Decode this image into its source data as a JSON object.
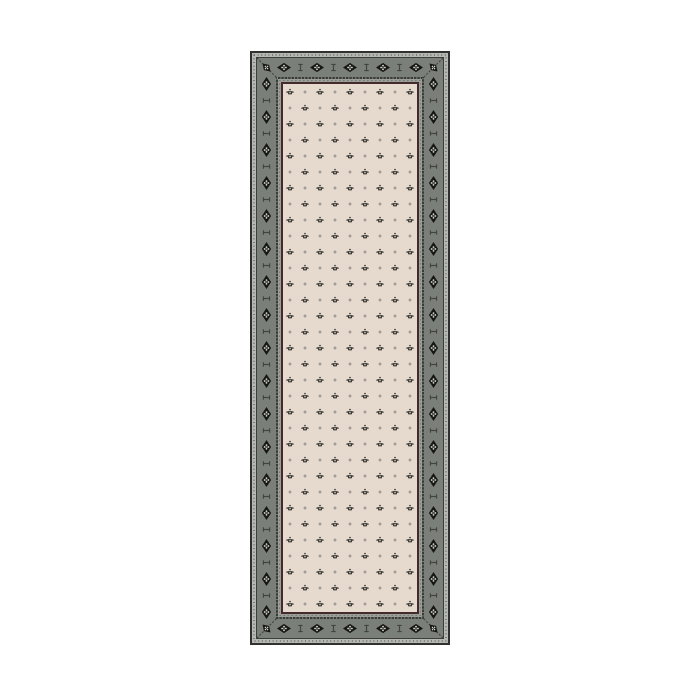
{
  "scene": {
    "type": "product-photo",
    "subject": "Rectangular runner rug, geometric bordered design: gray main border with black diamond medallions and cross motifs, cream field with staggered small floret and plus-dot motifs",
    "background_color": "#ffffff"
  },
  "rug": {
    "position": {
      "left": 250,
      "top": 51,
      "width": 200,
      "height": 594
    },
    "colors": {
      "outer_edge": "#30312f",
      "outer_guard": "#b6b9b3",
      "guard_dots": "#3d403b",
      "band": "#7b7f79",
      "band_edge_line": "#3c3e39",
      "motif_black": "#161614",
      "motif_light": "#d9dad3",
      "band_cross": "#42453f",
      "inner_guard": "#393b36",
      "inner_guard_dots": "#c7c9c3",
      "inner_stripe": "#9b9e97",
      "maroon_line": "#442a2c",
      "field": "#e6d9ce",
      "fleur_dark": "#36352f",
      "fleur_light": "#d8ccc0",
      "field_dot": "#8d8780"
    },
    "border": {
      "total_width": 33,
      "band_centerline": 16.5,
      "top_bottom": {
        "diamond_xs": [
          34,
          67,
          100,
          133,
          166
        ],
        "cross_xs": [
          50.5,
          83.5,
          116.5,
          149.5
        ]
      },
      "sides": {
        "diamond_start_y": 33,
        "diamond_spacing": 33,
        "diamond_count": 17,
        "cross_start_y": 49.5,
        "cross_spacing": 33,
        "cross_count": 16
      },
      "corner_centers": [
        [
          16.5,
          16.5
        ],
        [
          183.5,
          16.5
        ],
        [
          16.5,
          577.5
        ],
        [
          183.5,
          577.5
        ]
      ]
    },
    "field_pattern": {
      "tile_w": 30,
      "tile_h": 32,
      "row_spacing": 16,
      "motif_spacing_x": 15,
      "pattern_origin_x": 2.5,
      "pattern_origin_y": 1
    }
  }
}
